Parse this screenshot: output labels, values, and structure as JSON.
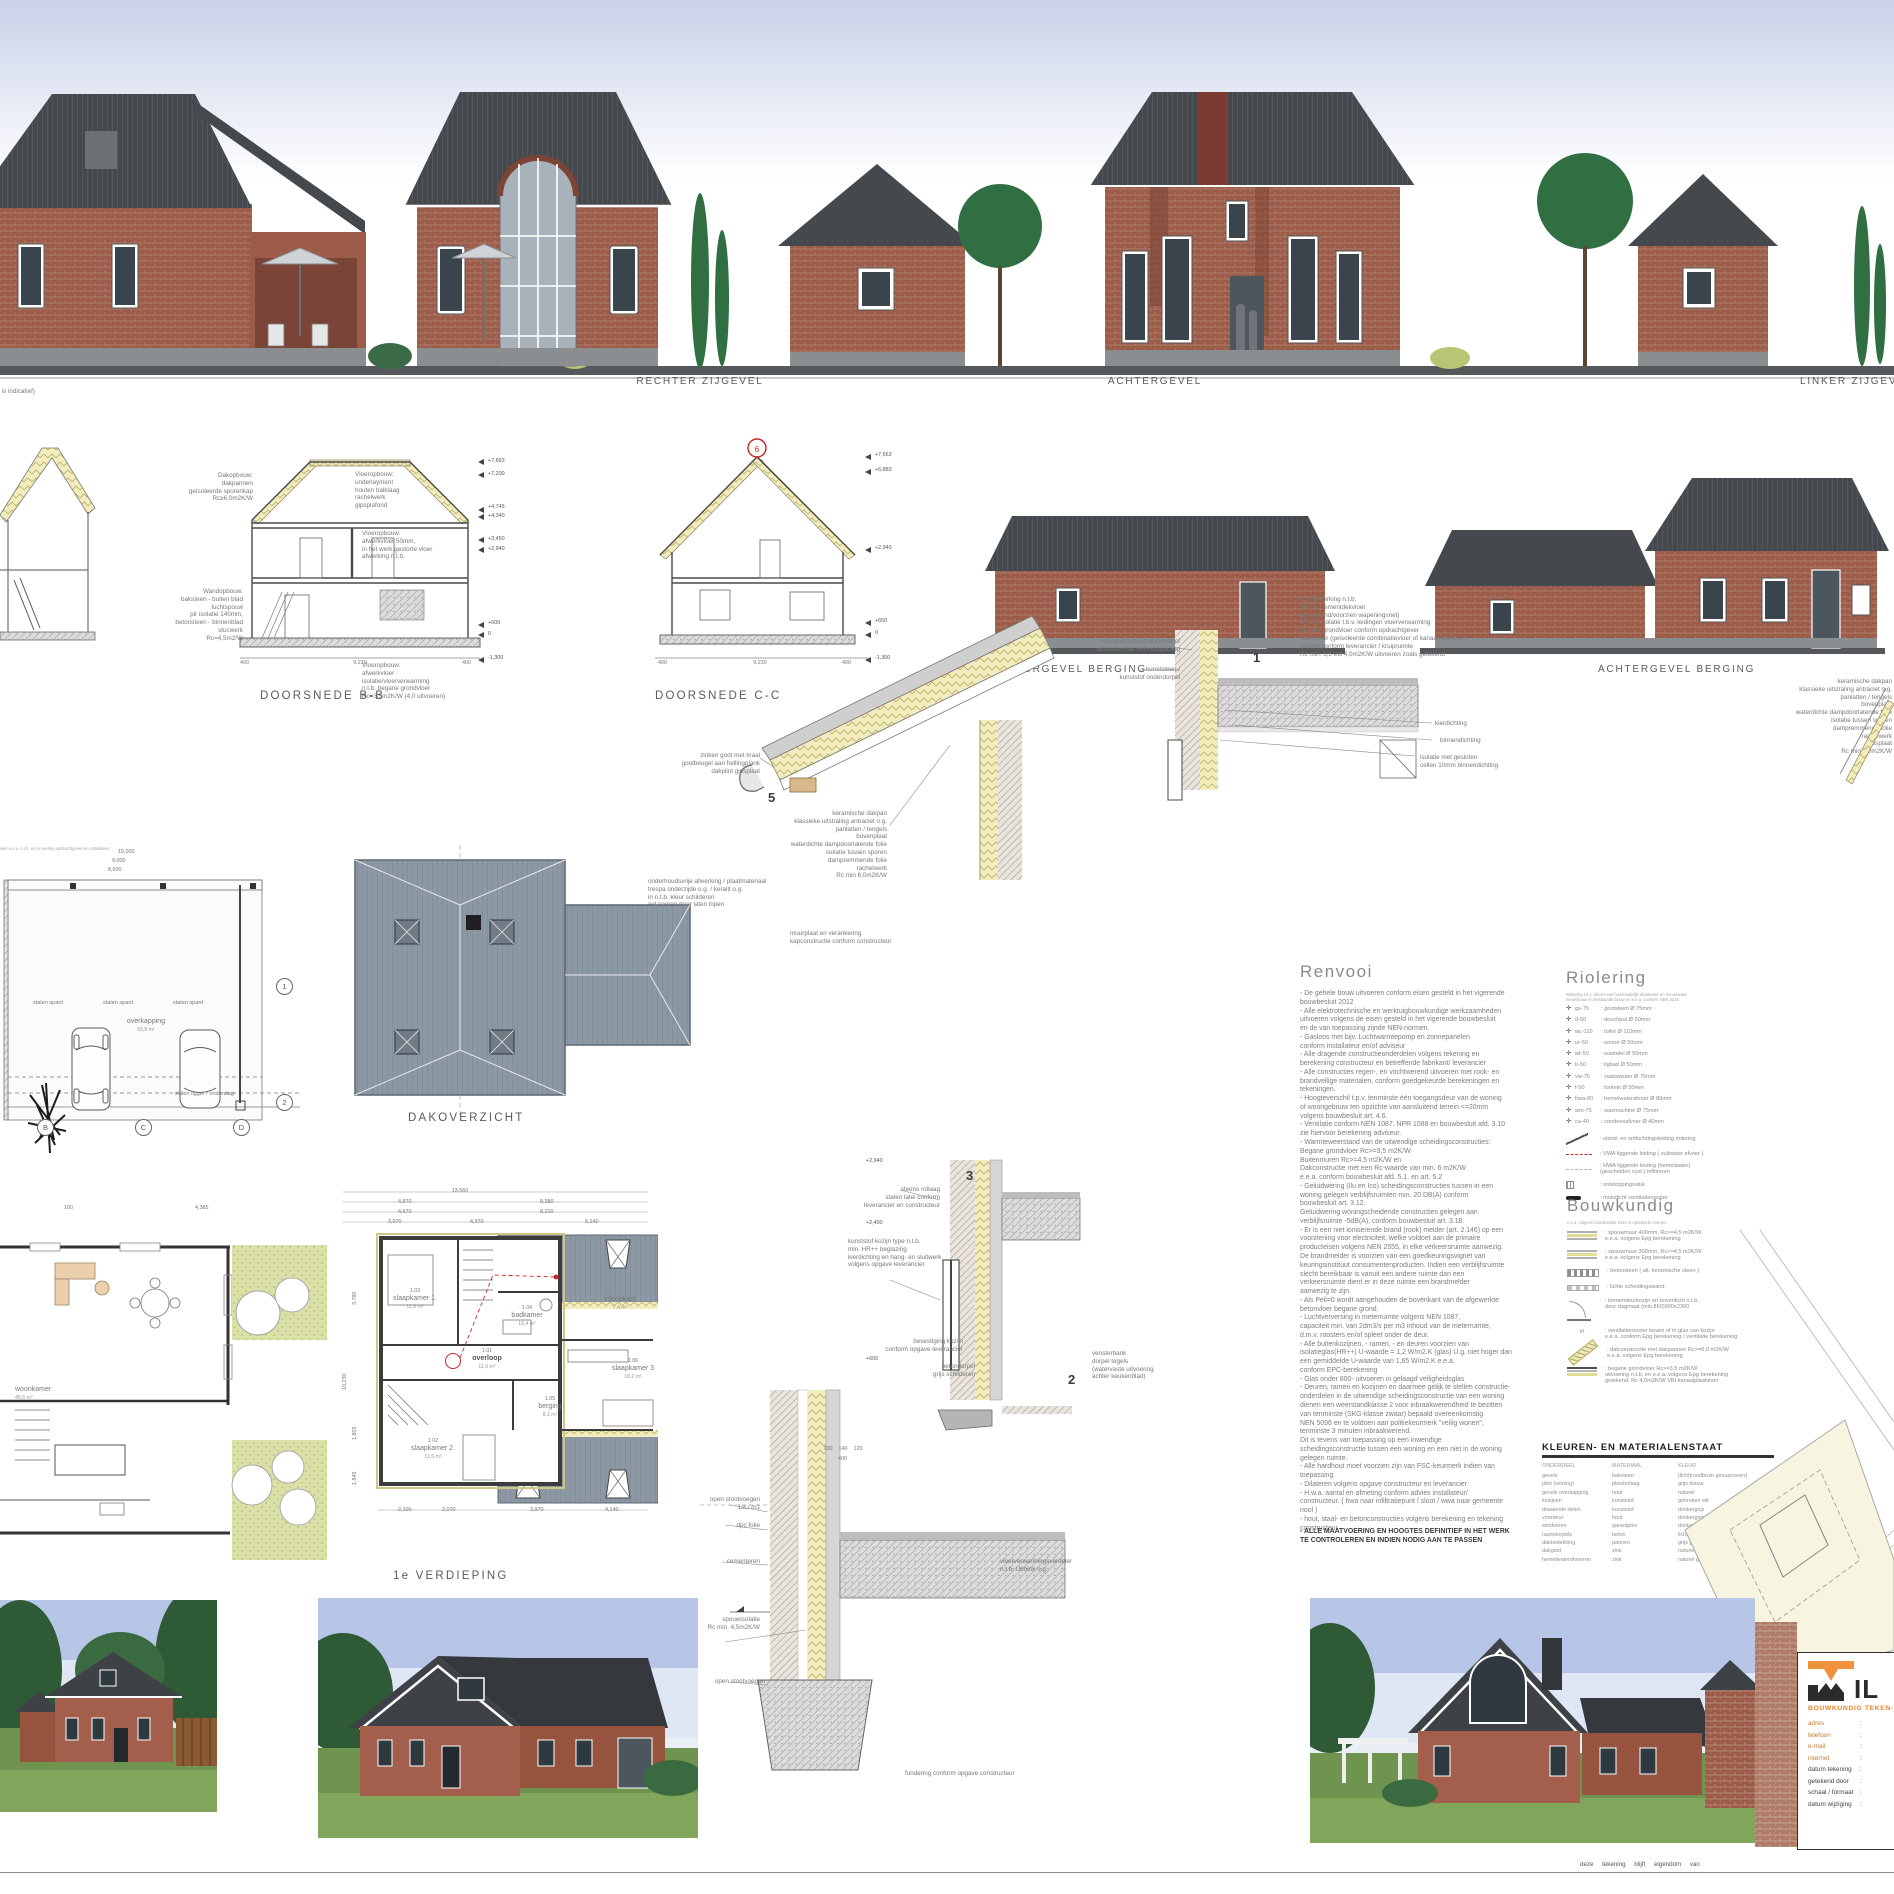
{
  "sheet": {
    "masonry_note": "(metselwerk is indicatief)",
    "footer_note": "deze tekening blijft eigendom van"
  },
  "elevations": {
    "labels": [
      "RECHTER ZIJGEVEL",
      "ACHTERGEVEL",
      "LINKER ZIJGEVEL"
    ]
  },
  "sections": {
    "doorsnede_bb": "DOORSNEDE B-B",
    "doorsnede_cc": "DOORSNEDE C-C",
    "voorgevel_berging": "VOORGEVEL BERGING",
    "achtergevel_berging": "ACHTERGEVEL BERGING",
    "ann_dakopbouw": "Dakopbouw:\ndakpannen\ngeïsoleerde sporenkap\nRc≥6,0m2K/W",
    "ann_vloer1": "Vloeropbouw:\nunderlayment\nhouten balklaag\nrachelwerk\ngipsplafond",
    "ann_vloer2": "Vloeropbouw:\nafwerkvloer 50mm,\nin het werk gestorte vloer\nafwerking n.t.b.",
    "ann_wand": "Wandopbouw:\nbaksteen - buiten blad\nluchtspouw\npir isolatie 140mm,\nbetonsteen - binnenblad\nstucwerk\nRc=4,5m2/W",
    "ann_vloer3": "Vloeropbouw:\nafwerkvloer\nisolatie/vloerverwarming\nn.t.b. begane grondvloer\nRc=3,5m2K/W (4,0 uitvoeren)",
    "levels_bb": [
      "+7,663",
      "+7,200",
      "+4,745",
      "+4,340",
      "+3,450",
      "+2,940",
      "+600",
      "0",
      "-1,300"
    ],
    "levels_cc": [
      "+7,663",
      "+6,883",
      "+2,940",
      "+650",
      "0",
      "-1,300"
    ],
    "dim_9230": "9,230",
    "dim_400": "400",
    "circle6": "6"
  },
  "plans": {
    "top_notes": "gradenverdeling van zonnepanelen e.e.a. n.t.b. en in overleg opdrachtgever en installateur\npeil gemeente Aalten",
    "overkapping": "overkapping",
    "overkapping_area": "65,8 m²",
    "stalen_spant": "stalen spant",
    "stalen_ligger": "stalen ligger / onderslag",
    "grid_letters": [
      "B",
      "C",
      "D"
    ],
    "grid_numbers": [
      "1",
      "2"
    ],
    "dims_site": [
      "15,000",
      "9,000",
      "8,600"
    ],
    "woonkamer": "woonkamer",
    "woonkamer_area": "48,5 m²",
    "dim_100": "100",
    "dim_4385": "4,385",
    "dakoverzicht_label": "DAKOVERZICHT",
    "verdieping_label": "1e VERDIEPING",
    "rooms": {
      "sk1": {
        "num": "1.03",
        "name": "slaapkamer 1.",
        "area": "11,6 m²"
      },
      "badkamer": {
        "num": "1.04",
        "name": "badkamer",
        "area": "10,4 m²"
      },
      "overloop": {
        "num": "1.01",
        "name": "overloop",
        "area": "11,6 m²"
      },
      "sk2": {
        "num": "1.02",
        "name": "slaapkamer 2.",
        "area": "11,6 m²"
      },
      "berging": {
        "num": "1.05",
        "name": "berging",
        "area": "8,1 m²"
      },
      "sk3": {
        "num": "1.06",
        "name": "slaapkamer 3",
        "area": "18,2 m²"
      },
      "inloopkast": {
        "num": "1.07",
        "name": "inloopkast",
        "area": "7,4 m²"
      }
    },
    "dims_top": [
      "13,560",
      "4,870",
      "8,380",
      "4,670",
      "8,210",
      "3,070",
      "4,370",
      "5,140"
    ],
    "dims_bottom": [
      "2,100",
      "2,070",
      "3,970",
      "4,140"
    ],
    "dims_left": [
      "3,780",
      "10,230",
      "1,805",
      "1,845"
    ]
  },
  "details": {
    "n1": "1",
    "n2": "2",
    "n3": "3",
    "n5": "5",
    "roof_stack": "keramische dakpan\nklassieke uitstraling antraciet o.g.\npanlatten / tengels\nbovenplaat\nwaterdichte dampdoorlatende folie\nisolatie tussen sporen\ndampremmende folie\nrachelwerk\nRc min 6,0m2K/W",
    "goot": "zinken goot met kraal\ngootbeugel aan hellingplank\ndakplint gipsplaat",
    "boeideel": "onderhoudsvrije afwerking / plaatmateriaal\ntrespa onderzijde o.g. / keralit o.g.\nin n.t.b. kleur schilderen\nevt sporen door laten lopen",
    "muurplaat": "muurplaat en verankering\nkapconstructie conform constructeur",
    "lvl_2940": "+2,940",
    "rollaag": "steens rollaag\nstalen latei conform\nleverancier en constructeur",
    "lvl_2400": "+2,400",
    "kozijn": "kunststof kozijn type n.t.b.\nmin. HR++ beglazing\nkierdichting en hang- en sluitwerk\nvolgens opgave leverancier",
    "bevestiging": "bevestiging kozijn\nconform opgave leverancier",
    "lvl_600": "+600",
    "betondorpel": "betondorpel\ngrijs schilderen",
    "vensterbank": "vensterbank\ndorpel tegels\n(watervaste uitvoering\nachter keukenblad)",
    "stootvoegen1": "open stootvoegen\n1st./ m1",
    "dpc": "dpc folie",
    "cementeren": "cementeren",
    "spouwisolatie": "spouwisolatie\nRc min. 4,5m2K/W",
    "stootvoegen2": "open stootvoegen",
    "vloerverw": "vloerverwarmingsverdeler\nn.t.b. Ubbink o.g.",
    "fundering": "fundering conform opgave constructeur",
    "dim_chain": "100    140    120",
    "dim_400": "400",
    "d1_right": "vloerafwerking n.t.b.\n50mm, cementdekvloer\n(gewapend/voorzien wapeningsnet)\n20mm, isolatie t.b.v. leidingen vloerverwarming\nbegane grondvloer conform opdrachtgever\naannemer (geïsoleerde combinatievloer of kanaalplaatvloer)\nisolatie conform leverancier / kruipruimte\nRc min. 3,5 evt 4,0m2K/W uitvoeren zoals getekend",
    "d1_kier": "kierdichting",
    "d1_binnen": "binnendichting",
    "d1_isolatie": "isolatie met gesloten\ncellen 10mm binnendichting",
    "d1_voordeur": "voordeur in hout of kunststof\nuitvoeren met HR++beglazing",
    "d1_dorpel": "kunststeen /\nkunststof onderdorpel",
    "far_right_stack": "keramische dakpan\nklassieke uitstraling antraciet o.g.\npanlatten / tengels\nbovenplaat\nwaterdichte dampdoorlatende folie\nisolatie tussen sporen\ndampremmende folie\nrachelwerk\ngipsplaat\nRc min 6,0m2K/W"
  },
  "renvooi": {
    "title": "Renvooi",
    "text": "- De gehele bouw uitvoeren conform eisen gesteld in het vigerende\nbouwbesluit 2012\n- Alle elektrotechnische en werktuigbouwkundige werkzaamheden\nuitvoeren volgens de eisen gesteld in het vigerende bouwbesluit\nen de van toepassing zijnde NEN-normen.\n- Gasloos met bijv. Luchtwarmtepomp en zonnepanelen\nconform installateur en/of adviseur\n- Alle dragende constructieonderdelen volgens tekening en\nberekening constructeur en betreffende fabrikant/ leverancier\n- Alle constructies regen-, en vochtwerend uitvoeren met rook- en\nbrandveilige materialen, conform goedgekeurde berekeningen en\ntekeningen.\n- Hoogteverschil t.p.v. tenminste één toegangsdeur van de woning\nof woongebouw ten opzichte van aansluitend terrein <=20mm\nvolgens bouwbesluit art. 4.6.\n- Ventilatie conform NEN 1087, NPR 1088 en bouwbesluit afd. 3.10\nzie hiervoor berekening adviseur.\n- Warmteweerstand van de uitwendige scheidingsconstructies:\nBegane grondvloer Rc>=3,5 m2K/W\nBuitenmuren Rc>=4,5 m2K/W en\nDakconstructie met een Rc-waarde van min. 6 m2K/W\ne.e.a. conform bouwbesluit afd. 5.1. en art. 5.2\n- Geluidwering (Ilu en Ico) scheidingsconstructies tussen in een\nwoning gelegen verblijfsruimten min. 20 DB(A) conform\nbouwbesluit art. 3.12.\nGeluidwering woningscheidende constructies gelegen aan\nverblijfsruimte -5dB(A), conform bouwbesluit art. 3.18.\n- Er is een niet ioniserende brand (rook) melder (art. 2.146) op een\nvoorziening voor electriciteit, welke voldoet aan de primaire\nproducteisen volgens NEN 2555, in elke verkeersruimte aanwezig.\nDe brandmelder is voorzien van een goedkeuringsvignet van\nkeuringsinstituut consumentenproducten. Indien een verblijfsruimte\nslecht bereikbaar is vanuit een andere ruimte dan een\nverkeersruimte dient er in deze ruimte een brandmelder\naanwezig te zijn.\n- Als Peil=0 wordt aangehouden de bovenkant van de afgewerkte\nbetonvloer begane grond.\n- Luchtverversing in meterruimte volgens NEN 1087,\ncapaciteit min. van 2dm3/s per m3 inhoud van de meterruimte,\nd.m.v. roosters en/of spleet onder de deur.\n- Alle buitenkozijnen, - ramen, - en deuren voorzien van\nisolatieglas(HR++) U-waarde = 1,2 W/m2.K (glas) U.g. niet hoger dan\neen gemiddelde U-waarde van 1,65 W/m2.K e.e.a.\nconform EPC-berekening\n- Glas onder 800- uitvoeren in gelaagd veiligheidsglas\n- Deuren, ramen en kozijnen en daarmee gelijk te stellen constructie-\nonderdelen in de uitwendige scheidingsconstructie van een woning\ndienen een weerstandklasse 2 voor inbraakwerendheid te bezitten\nvan tenminste (SKG-klasse zwaar) bepaald overeenkomstig\nNEN 5096 en te voldoen aan politiekeurmerk \"veilig wonen\",\ntenminste 3 minuten inbraakwerend.\nDit is tevens van toepassing op een inwendige\nscheidingsconstructie tussen een woning en een niet in de woning\ngelegen ruimte.\n- Alle hardhout moet voorzien zijn van FSC-keurmerk indien van\ntoepassing\n- Dilateren volgens opgave constructeur en leverancier.\n- H.w.a. aantal en afmeting conform advies installateur/\nconstructeur. ( hwa naar infiltratiepunt / sloot / wwa naar gemeente\nriool )\n- hout, staal- en betonconstructies volgens berekening en tekening\nconstructeur.",
    "bold": "- ALLE MAATVOERING EN HOOGTES DEFINITIEF IN HET WERK\nTE CONTROLEREN EN INDIEN NODIG AAN TE PASSEN"
  },
  "riolering": {
    "title": "Riolering",
    "subtitle": "Riolering t.b.v. afvoer van huishoudelijk afvalwater en hemelwater\nnieuwbouw en bestaande bouw en e.e.a. conform NEN 3215",
    "items": [
      {
        "code": "gs-75",
        "desc": ": gootsteen Ø 75mm"
      },
      {
        "code": "d-50",
        "desc": ": douchput Ø 50mm"
      },
      {
        "code": "wc-110",
        "desc": ": toilet Ø 110mm"
      },
      {
        "code": "ur-50",
        "desc": ": urinoir Ø 50mm"
      },
      {
        "code": "wt-50",
        "desc": ": wastafel Ø 50mm"
      },
      {
        "code": "b-50",
        "desc": ": ligbad Ø 50mm"
      },
      {
        "code": "vw-75",
        "desc": ": vaatwasser Ø 75mm"
      },
      {
        "code": "f-50",
        "desc": ": fontein Ø 50mm"
      },
      {
        "code": "hwa-80",
        "desc": ": hemelwaterafvoer Ø 80mm"
      },
      {
        "code": "wm-75",
        "desc": ": wasmachine Ø 75mm"
      },
      {
        "code": "ca-40",
        "desc": ": condensafvoer Ø 40mm"
      }
    ],
    "symbols": [
      {
        "sym": "sym-stand",
        "desc": ": stand- en ontluchtingsleiding riolering"
      },
      {
        "sym": "sym-vwa",
        "desc": ": VWA liggende leiding ( vuilwater afvoer )"
      },
      {
        "sym": "sym-hwa",
        "desc": ": HWA liggende leiding (hemelwater)\n(gescheiden syst.) infiltreren"
      },
      {
        "sym": "sym-ont",
        "desc": ": ontstoppingsstuk"
      },
      {
        "sym": "sym-muis",
        "desc": ": muisdicht ventilatierooster"
      }
    ]
  },
  "bouwkundig": {
    "title": "Bouwkundig",
    "subtitle": "e.e.a. volgens bouwbesluit 2012 en geldende normen",
    "items": [
      {
        "icon": "i-wall400",
        "glyph": "",
        "text": ": spouwmuur 400mm, Rc>=4,5 m2K/W\ne.e.a. volgens Epg berekening"
      },
      {
        "icon": "i-wall300",
        "glyph": "",
        "text": ": spouwmuur 300mm, Rc>=4,5 m2K/W\ne.e.a. volgens Epg berekening"
      },
      {
        "icon": "i-beton",
        "glyph": "",
        "text": ": betonsteen ( alt. keramische steen )"
      },
      {
        "icon": "i-licht",
        "glyph": "",
        "text": ": lichte scheidingswand"
      },
      {
        "icon": "i-deur",
        "glyph": "",
        "text": ": binnendeurkozijn en bovenlicht n.t.b.\ndeur dagmaat (min.850)900x2300"
      },
      {
        "icon": "i-vr",
        "glyph": "vr",
        "text": ": ventilatierooster boven of in glas van kozijn\ne.e.a. conform Epg berekening / ventilatie berekening"
      },
      {
        "icon": "i-dak",
        "glyph": "",
        "text": ": dakconstructie met dakpannen Rc>=6,0 m2K/W\ne.e.a. volgens Epg berekening"
      },
      {
        "icon": "i-vloer",
        "glyph": "",
        "text": ": begane grondvloer Rc>=3,5 m2K/W\nuitvoering n.t.b. en e.e.a. volgens Epg berekening\ngetekend: Rc 4,0m2K/W VBI kanaalplaatvloer"
      }
    ]
  },
  "materials": {
    "title": "KLEUREN- EN MATERIALENSTAAT",
    "headers": [
      "ONDERDEEL",
      "MATERIAAL",
      "KLEUR"
    ],
    "rows": [
      {
        "part": "gevels",
        "mat": "baksteen",
        "col": "(licht)roodbruin genuanceerd"
      },
      {
        "part": "plint (woning)",
        "mat": "pleisterlaag",
        "col": "grijs blauw"
      },
      {
        "part": "gevels overkapping",
        "mat": "hout",
        "col": "naturel"
      },
      {
        "part": "kozijnen",
        "mat": "kunststof",
        "col": "gebroken wit"
      },
      {
        "part": "draaiende delen",
        "mat": "kunststof",
        "col": "donkergrijs"
      },
      {
        "part": "voordeur",
        "mat": "hout",
        "col": "donkergrijs"
      },
      {
        "part": "windveren",
        "mat": "garantplex",
        "col": "donkergrijs"
      },
      {
        "part": "raamdorpels",
        "mat": "beton",
        "col": "lichtgrijs"
      },
      {
        "part": "dakbedekking",
        "mat": "pannen",
        "col": "grijs genuanceerd(mat)"
      },
      {
        "part": "dakgoot",
        "mat": "zink",
        "col": "naturel grijs"
      },
      {
        "part": "hemelwaterafvoeren",
        "mat": "zink",
        "col": "naturel grijs"
      }
    ]
  },
  "titleblock": {
    "logo_letters": "IL",
    "company": "BOUWKUNDIG TEKEN- & A",
    "fields": [
      {
        "label": "adres",
        "sep": ":",
        "value": "709",
        "cls": "orange"
      },
      {
        "label": "telefoon",
        "sep": ":",
        "value": "0",
        "cls": "orange"
      },
      {
        "label": "e-mail",
        "sep": ":",
        "value": "info@te",
        "cls": "orange"
      },
      {
        "label": "internet",
        "sep": ":",
        "value": "www.te",
        "cls": "orange"
      },
      {
        "label": "datum tekening",
        "sep": ":",
        "value": "",
        "cls": "dark"
      },
      {
        "label": "getekend door",
        "sep": ":",
        "value": "",
        "cls": "dark"
      },
      {
        "label": "schaal / formaat",
        "sep": ":",
        "value": "",
        "cls": "dark"
      },
      {
        "label": "datum wijziging",
        "sep": ":",
        "value": "",
        "cls": "dark"
      }
    ],
    "colors": {
      "accent": "#f0913b",
      "dark": "#2b2b2b"
    }
  }
}
